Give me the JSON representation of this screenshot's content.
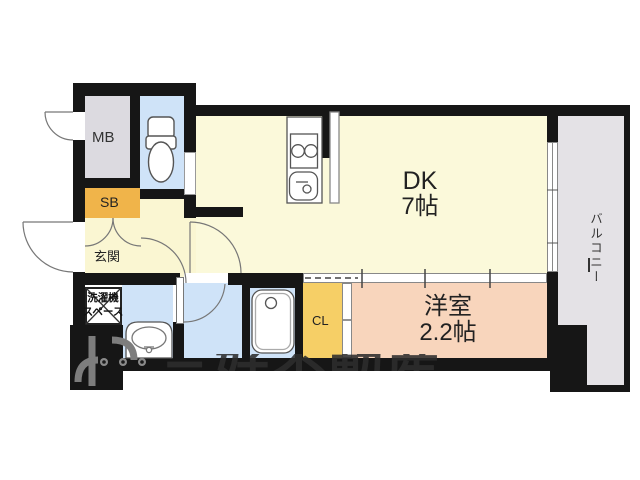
{
  "plan": {
    "type": "apartment-floor-plan",
    "rooms": {
      "mb": {
        "label": "MB"
      },
      "sb": {
        "label": "SB"
      },
      "genkan": {
        "label": "玄関"
      },
      "washer_space": {
        "label_line1": "洗濯機",
        "label_line2": "スペース"
      },
      "dk": {
        "label": "DK",
        "size": "7帖"
      },
      "cl": {
        "label": "CL"
      },
      "western_room": {
        "label": "洋室",
        "size": "2.2帖"
      },
      "balcony": {
        "label": "バルコニー"
      }
    },
    "watermark": {
      "text": "三好不動産"
    },
    "colors": {
      "wall": "#161616",
      "mb_floor": "#dcdae0",
      "balcony_floor": "#e4e2e6",
      "wet_area_floor": "#cfe3f8",
      "dk_floor": "#fbf9da",
      "genkan_floor": "#faf6d2",
      "sb_fill": "#f0b44a",
      "cl_fill": "#f6cf66",
      "western_floor": "#f8d5bc",
      "watermark_gray": "#3a3a3a"
    }
  }
}
